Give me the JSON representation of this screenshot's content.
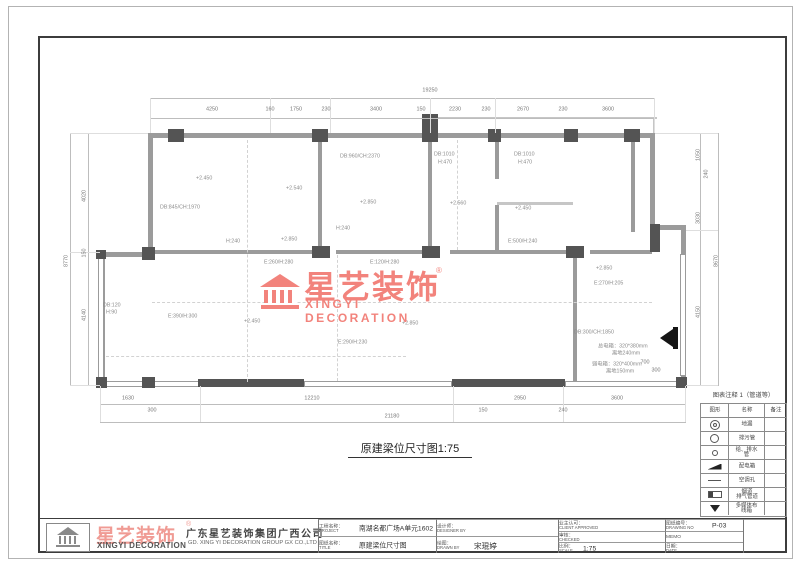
{
  "sheet": {
    "drawing_title": "原建梁位尺寸图1:75"
  },
  "watermark": {
    "cn": "星艺装饰",
    "reg": "®",
    "en": "XINGYI DECORATION",
    "color": "#f2837c"
  },
  "legend": {
    "title": "图表注释 1（管道等）",
    "headers": [
      "图形",
      "名称",
      "备注"
    ],
    "rows": [
      {
        "icon": "floor-drain-icon",
        "name": "地漏",
        "note": ""
      },
      {
        "icon": "sewage-pipe-icon",
        "name": "排污管",
        "note": ""
      },
      {
        "icon": "water-pipe-icon",
        "name": "给、排水管",
        "note": ""
      },
      {
        "icon": "power-box-icon",
        "name": "配电箱",
        "note": ""
      },
      {
        "icon": "ac-hole-icon",
        "name": "空调孔",
        "note": ""
      },
      {
        "icon": "flue-icon",
        "name": "烟道\n排气管道",
        "note": ""
      },
      {
        "icon": "multimedia-box-icon",
        "name": "多媒体布线箱",
        "note": ""
      }
    ]
  },
  "title_block": {
    "logo_cn": "星艺装饰",
    "logo_reg": "®",
    "logo_en": "XINGYI DECORATION",
    "company_cn": "广东星艺装饰集团广西公司",
    "company_en": "GD. XING YI DECORATION GROUP GX CO.,LTD",
    "cells": [
      {
        "label": "工程名称：",
        "en": "PROJECT",
        "value": "南湖名都广场A单元1602"
      },
      {
        "label": "设计师：",
        "en": "DESIGNER BY",
        "value": ""
      },
      {
        "label": "图纸名称：",
        "en": "TITLE",
        "value": "原建梁位尺寸图"
      },
      {
        "label": "绘图：",
        "en": "DRAWN BY",
        "value": "宋琨婷"
      },
      {
        "label": "业主认可：",
        "en": "CLIENT APPROVED",
        "value": ""
      },
      {
        "label": "图纸编号：",
        "en": "DRAWING NO",
        "value": "P-03"
      },
      {
        "label": "审核：",
        "en": "CHECKED",
        "value": ""
      },
      {
        "label": "MEMO",
        "en": "",
        "value": ""
      },
      {
        "label": "比例：",
        "en": "SCALE",
        "value": "1:75"
      },
      {
        "label": "日期：",
        "en": "DATE",
        "value": ""
      }
    ]
  },
  "dimensions": {
    "top_overall": {
      "t": "19250",
      "x": 430,
      "y": 90
    },
    "top_chain": [
      {
        "t": "4250",
        "x": 212,
        "y": 109
      },
      {
        "t": "160",
        "x": 270,
        "y": 109
      },
      {
        "t": "1750",
        "x": 296,
        "y": 109
      },
      {
        "t": "230",
        "x": 326,
        "y": 109
      },
      {
        "t": "3400",
        "x": 376,
        "y": 109
      },
      {
        "t": "150",
        "x": 421,
        "y": 109
      },
      {
        "t": "2230",
        "x": 455,
        "y": 109
      },
      {
        "t": "230",
        "x": 486,
        "y": 109
      },
      {
        "t": "2670",
        "x": 523,
        "y": 109
      },
      {
        "t": "230",
        "x": 563,
        "y": 109
      },
      {
        "t": "3600",
        "x": 608,
        "y": 109
      }
    ],
    "bottom_overall": {
      "t": "21180",
      "x": 392,
      "y": 416
    },
    "bottom_chain": [
      {
        "t": "1630",
        "x": 128,
        "y": 398
      },
      {
        "t": "300",
        "x": 152,
        "y": 410
      },
      {
        "t": "12210",
        "x": 312,
        "y": 398
      },
      {
        "t": "150",
        "x": 483,
        "y": 410
      },
      {
        "t": "2950",
        "x": 520,
        "y": 398
      },
      {
        "t": "240",
        "x": 563,
        "y": 410
      },
      {
        "t": "3600",
        "x": 617,
        "y": 398
      }
    ],
    "left_overall": {
      "t": "8770",
      "x": 66,
      "y": 261
    },
    "left_chain": [
      {
        "t": "4020",
        "x": 84,
        "y": 196
      },
      {
        "t": "150",
        "x": 84,
        "y": 253
      },
      {
        "t": "4140",
        "x": 84,
        "y": 315
      }
    ],
    "right_overall": {
      "t": "8670",
      "x": 716,
      "y": 261
    },
    "right_chain": [
      {
        "t": "1050",
        "x": 698,
        "y": 155
      },
      {
        "t": "240",
        "x": 706,
        "y": 174
      },
      {
        "t": "3030",
        "x": 698,
        "y": 218
      },
      {
        "t": "4150",
        "x": 698,
        "y": 312
      }
    ],
    "misc": [
      {
        "t": "700",
        "x": 645,
        "y": 362
      },
      {
        "t": "300",
        "x": 656,
        "y": 370
      }
    ]
  },
  "plan_labels": [
    {
      "t": "DB:845/CH:1970",
      "x": 160,
      "y": 204
    },
    {
      "t": "+2.450",
      "x": 196,
      "y": 175
    },
    {
      "t": "H:240",
      "x": 226,
      "y": 238
    },
    {
      "t": "+2.540",
      "x": 286,
      "y": 185
    },
    {
      "t": "DB:960/CH:2370",
      "x": 340,
      "y": 153
    },
    {
      "t": "+2.850",
      "x": 360,
      "y": 199
    },
    {
      "t": "DB:1010",
      "x": 434,
      "y": 151
    },
    {
      "t": "H:470",
      "x": 438,
      "y": 159
    },
    {
      "t": "+2.560",
      "x": 450,
      "y": 200
    },
    {
      "t": "DB:1010",
      "x": 514,
      "y": 151
    },
    {
      "t": "H:470",
      "x": 518,
      "y": 159
    },
    {
      "t": "+2.450",
      "x": 515,
      "y": 205
    },
    {
      "t": "E:500/H:240",
      "x": 508,
      "y": 238
    },
    {
      "t": "H:240",
      "x": 336,
      "y": 225
    },
    {
      "t": "+2.850",
      "x": 281,
      "y": 236
    },
    {
      "t": "E:260/H:280",
      "x": 264,
      "y": 259
    },
    {
      "t": "E:120/H:280",
      "x": 370,
      "y": 259
    },
    {
      "t": "+2.850",
      "x": 596,
      "y": 265
    },
    {
      "t": "E:270/H:205",
      "x": 594,
      "y": 280
    },
    {
      "t": "DB:300/CH:1850",
      "x": 574,
      "y": 329
    },
    {
      "t": "总电箱：320*380mm",
      "x": 598,
      "y": 342
    },
    {
      "t": "离地240mm",
      "x": 612,
      "y": 349
    },
    {
      "t": "弱电箱：320*400mm",
      "x": 592,
      "y": 360
    },
    {
      "t": "离地150mm",
      "x": 606,
      "y": 367
    },
    {
      "t": "E:390/H:300",
      "x": 168,
      "y": 313
    },
    {
      "t": "+2.450",
      "x": 244,
      "y": 318
    },
    {
      "t": "+2.850",
      "x": 402,
      "y": 320
    },
    {
      "t": "E:290/H:230",
      "x": 338,
      "y": 339
    },
    {
      "t": "DB:120",
      "x": 103,
      "y": 302
    },
    {
      "t": "H:90",
      "x": 106,
      "y": 309
    }
  ]
}
